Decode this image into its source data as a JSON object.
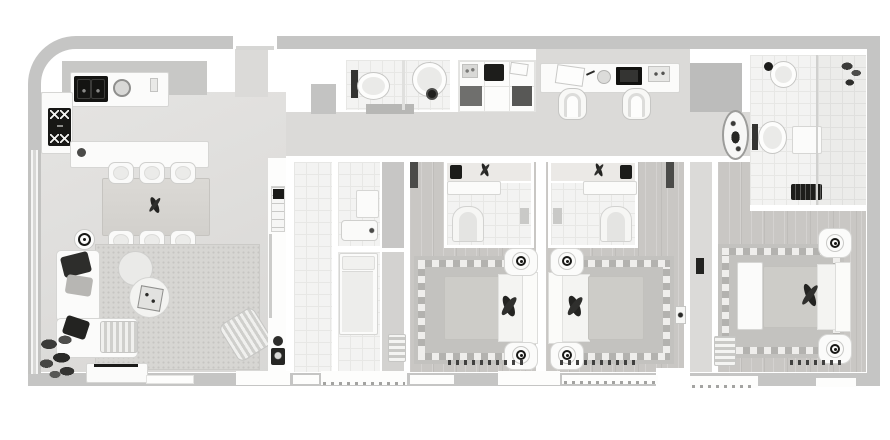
{
  "meta": {
    "kind": "apartment-floor-plan",
    "view": "top-down",
    "render_style": "grayscale 3d render",
    "text_visible": false
  },
  "palette": {
    "background": "#ffffff",
    "wall_outer": "#c5c5c4",
    "wall_inner": "#ffffff",
    "floor_corridor": "#dbdad8",
    "floor_tile": "#f3f3f2",
    "floor_wood": "#c9c7c4",
    "rug_living": "#d7d6d3",
    "rug_bedroom": "#c3c2bf",
    "checker_light": "#efeeec",
    "checker_dark": "#b3b2af",
    "furniture_white": "#fbfbfa",
    "accent_dark": "#1b1b19",
    "shaft_gray": "#bcbcbb"
  },
  "scene": {
    "rooms": [
      {
        "name": "kitchen",
        "items": [
          "wall-counter",
          "double-sink",
          "round-burner",
          "backsplash",
          "side-counter",
          "cooktop-4-burners",
          "island-with-faucet"
        ]
      },
      {
        "name": "dining-area",
        "items": [
          "rectangular-table",
          "centerpiece",
          "six-chairs",
          "floor-lamp"
        ]
      },
      {
        "name": "living-room",
        "items": [
          "dotted-rug",
          "l-shaped-sofa",
          "dark-pillows",
          "striped-ottoman",
          "two-round-coffee-tables",
          "decor-tray",
          "striped-lounge-chair",
          "large-plant",
          "tv-bench",
          "wall-panel-units"
        ]
      },
      {
        "name": "entry-hall",
        "items": [
          "front-door-opening",
          "doormat"
        ]
      },
      {
        "name": "utility-corridor",
        "items": [
          "tiled-floor",
          "sliding-door"
        ]
      },
      {
        "name": "maid-room",
        "items": [
          "single-bed",
          "small-bathroom",
          "vanity-cabinet",
          "bathtub"
        ]
      },
      {
        "name": "guest-bathroom",
        "items": [
          "wall-hung-toilet",
          "round-basin",
          "dark-stool"
        ]
      },
      {
        "name": "storage-closet",
        "items": [
          "shelving-grid",
          "washer-box",
          "linen"
        ]
      },
      {
        "name": "study-nook",
        "items": [
          "built-in-desk",
          "papers",
          "laptop",
          "tray",
          "two-desk-chairs",
          "service-shaft"
        ]
      },
      {
        "name": "bedroom-1",
        "items": [
          "double-bed",
          "two-nightstands-with-lamps",
          "checker-border-rug",
          "foot-runner",
          "towel-bench",
          "en-suite-with-vanity-and-toilet"
        ]
      },
      {
        "name": "bedroom-2",
        "items": [
          "double-bed",
          "two-nightstands-with-lamps",
          "checker-border-rug",
          "foot-runner",
          "wall-thermostat",
          "en-suite-with-vanity-and-toilet"
        ]
      },
      {
        "name": "master-bedroom",
        "items": [
          "double-bed",
          "two-nightstands-with-lamps",
          "checker-border-rug",
          "bedside-bench",
          "ladder-shelf",
          "foot-runner"
        ]
      },
      {
        "name": "master-bathroom",
        "items": [
          "round-basin",
          "wall-hung-toilet",
          "shower-with-glass",
          "plants",
          "dark-mat",
          "freestanding-tub"
        ]
      }
    ],
    "windows": [
      "left-wall-window",
      "bottom-wall-window-band"
    ],
    "openings": [
      "entry-door-top",
      "terrace-break-bottom-right"
    ]
  }
}
